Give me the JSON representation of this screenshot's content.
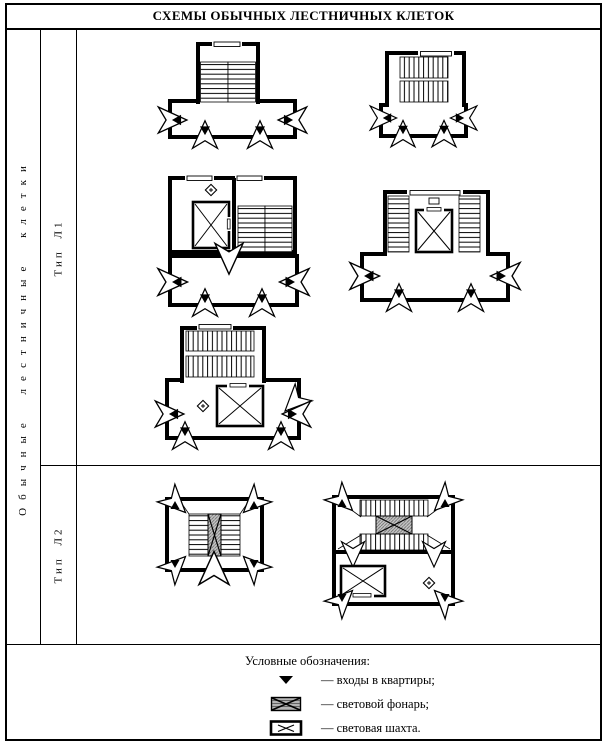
{
  "title": "СХЕМЫ ОБЫЧНЫХ ЛЕСТНИЧНЫХ КЛЕТОК",
  "table": {
    "group_label": "Обычные лестничные клетки",
    "type1_label": "Тип Л1",
    "type2_label": "Тип Л2"
  },
  "legend": {
    "heading": "Условные обозначения:",
    "items": [
      {
        "icon": "entrance-arrow-icon",
        "label": "— входы в квартиры;"
      },
      {
        "icon": "skylight-lantern-icon",
        "label": "— световой фонарь;"
      },
      {
        "icon": "light-shaft-icon",
        "label": "— световая шахта."
      }
    ]
  },
  "colors": {
    "ink": "#000000",
    "paper": "#ffffff"
  }
}
